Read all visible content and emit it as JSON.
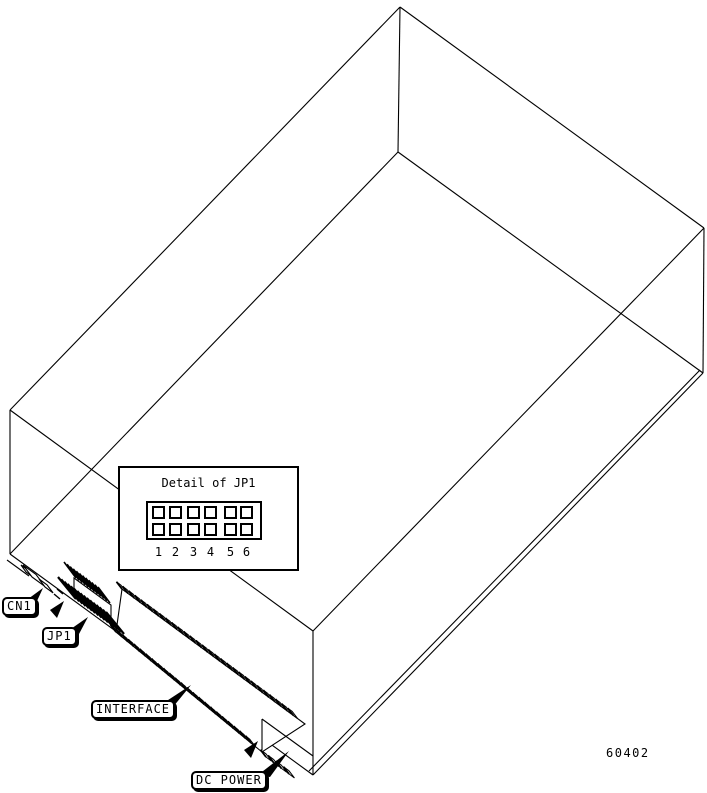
{
  "figure": {
    "background": "#ffffff",
    "line_color": "#000000",
    "part_number": "60402",
    "detail_box": {
      "title": "Detail of JP1",
      "rows": 2,
      "cols": 6,
      "pin_numbers": [
        "1",
        "2",
        "3",
        "4",
        "5",
        "6"
      ]
    },
    "callouts": [
      {
        "id": "cn1",
        "label": "CN1"
      },
      {
        "id": "jp1",
        "label": "JP1"
      },
      {
        "id": "interface",
        "label": "INTERFACE"
      },
      {
        "id": "dc-power",
        "label": "DC POWER"
      }
    ]
  }
}
